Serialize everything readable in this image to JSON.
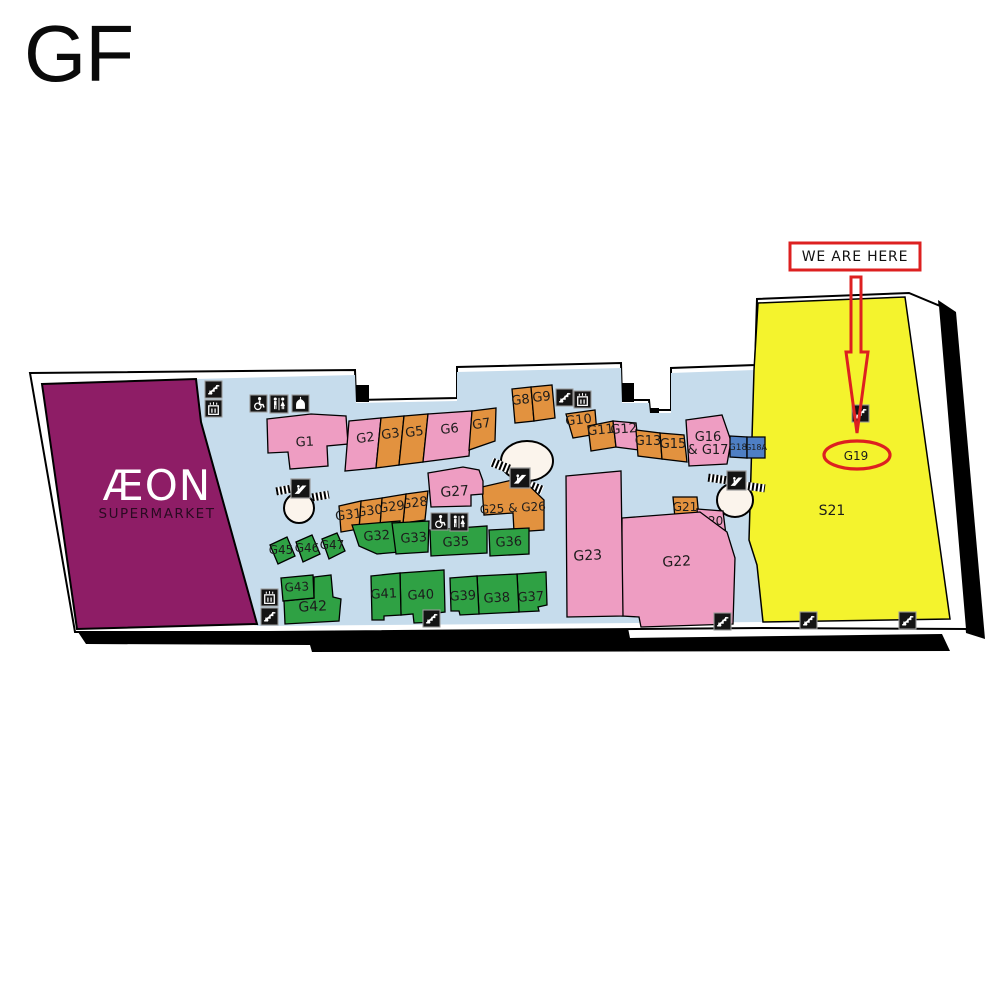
{
  "title": "GF",
  "annotation": {
    "we_are_here": "WE ARE HERE"
  },
  "colors": {
    "pink": "#ee9dc2",
    "orange": "#e2923f",
    "green": "#2fa144",
    "blue": "#4e7fc4",
    "purple": "#8e1d66",
    "yellow": "#f4f32d",
    "corridor": "#c6dcec",
    "red": "#dd2020",
    "circle": "#fbf4ec",
    "outline": "#000000",
    "label": "#1c1c1c",
    "icon_bg": "#141414",
    "icon_fg": "#ffffff"
  },
  "map": {
    "building_outline": "30,373 355,370 356,400 457,398 457,367 621,363 622,400 649,400 650,410 671,410 671,368 755,365 757,299 909,293 940,306 967,629 763,628 268,632 75,632",
    "shadow": [
      "78,632 628,628 630,638 942,634 950,651 312,652 310,645 86,644",
      "938,300 956,312 985,639 966,633"
    ],
    "pillars": [
      {
        "x": 356,
        "y": 385,
        "w": 13,
        "h": 17
      },
      {
        "x": 621,
        "y": 383,
        "w": 13,
        "h": 19
      },
      {
        "x": 647,
        "y": 408,
        "w": 12,
        "h": 11
      }
    ],
    "corridor": "196,379 355,375 356,403 457,401 457,372 621,368 622,403 649,403 650,413 671,413 671,373 754,370 749,540 757,565 763,622 257,626 201,424",
    "aeon": {
      "area": "42,384 196,379 201,422 257,624 77,629",
      "name": "ÆON",
      "sub": "SUPERMARKET",
      "x": 157,
      "y1": 500,
      "y2": 518
    },
    "yellow_area": "758,303 905,297 950,619 763,622 757,565 749,540 754,370",
    "area_labels": [
      {
        "text": "S21",
        "x": 832,
        "y": 515,
        "fs": 14
      },
      {
        "text": "G19",
        "x": 856,
        "y": 460,
        "fs": 12
      }
    ],
    "circles": [
      {
        "cx": 299,
        "cy": 508,
        "rx": 15,
        "ry": 15
      },
      {
        "cx": 527,
        "cy": 461,
        "rx": 26,
        "ry": 20
      },
      {
        "cx": 735,
        "cy": 500,
        "rx": 18,
        "ry": 17
      }
    ],
    "hatches": [
      {
        "x": 276,
        "y": 486,
        "w": 16,
        "h": 8,
        "rot": -10
      },
      {
        "x": 312,
        "y": 492,
        "w": 17,
        "h": 8,
        "rot": -10
      },
      {
        "x": 491,
        "y": 461,
        "w": 19,
        "h": 9,
        "rot": 22
      },
      {
        "x": 523,
        "y": 482,
        "w": 20,
        "h": 9,
        "rot": 22
      },
      {
        "x": 708,
        "y": 475,
        "w": 20,
        "h": 8,
        "rot": 8
      },
      {
        "x": 745,
        "y": 483,
        "w": 20,
        "h": 8,
        "rot": 8
      }
    ],
    "shops": [
      {
        "id": "G1",
        "label": "G1",
        "c": "pink",
        "pts": "267,419 311,414 346,416 348,444 327,446 328,466 290,469 288,452 268,453",
        "lx": 305,
        "ly": 446,
        "fs": 13,
        "rot": -3
      },
      {
        "id": "G2",
        "label": "G2",
        "c": "pink",
        "pts": "349,421 381,418 376,468 345,471",
        "lx": 366,
        "ly": 442,
        "fs": 13,
        "rot": -8
      },
      {
        "id": "G3",
        "label": "G3",
        "c": "orange",
        "pts": "381,418 404,416 399,465 376,468",
        "lx": 391,
        "ly": 438,
        "fs": 13,
        "rot": -8
      },
      {
        "id": "G5",
        "label": "G5",
        "c": "orange",
        "pts": "404,416 428,414 423,462 399,465",
        "lx": 415,
        "ly": 436,
        "fs": 13,
        "rot": -8
      },
      {
        "id": "G6",
        "label": "G6",
        "c": "pink",
        "pts": "428,414 472,411 469,456 423,462",
        "lx": 450,
        "ly": 433,
        "fs": 13,
        "rot": -6
      },
      {
        "id": "G7",
        "label": "G7",
        "c": "orange",
        "pts": "472,411 496,408 495,441 469,450",
        "lx": 482,
        "ly": 428,
        "fs": 13,
        "rot": -8
      },
      {
        "id": "G8",
        "label": "G8",
        "c": "orange",
        "pts": "512,389 531,387 534,421 515,423",
        "lx": 521,
        "ly": 404,
        "fs": 13,
        "rot": -6
      },
      {
        "id": "G9",
        "label": "G9",
        "c": "orange",
        "pts": "531,387 552,385 555,418 534,421",
        "lx": 542,
        "ly": 401,
        "fs": 13,
        "rot": -6
      },
      {
        "id": "G10",
        "label": "G10",
        "c": "orange",
        "pts": "566,414 595,410 597,434 573,438",
        "lx": 579,
        "ly": 424,
        "fs": 13,
        "rot": -6
      },
      {
        "id": "G11",
        "label": "G11",
        "c": "orange",
        "pts": "588,426 613,421 616,447 591,451",
        "lx": 601,
        "ly": 434,
        "fs": 13,
        "rot": -6
      },
      {
        "id": "G12",
        "label": "G12",
        "c": "pink",
        "pts": "613,421 636,423 639,450 616,447",
        "lx": 624,
        "ly": 433,
        "fs": 13,
        "rot": -4
      },
      {
        "id": "G13",
        "label": "G13",
        "c": "orange",
        "pts": "636,430 660,433 662,459 638,456",
        "lx": 648,
        "ly": 445,
        "fs": 13,
        "rot": 0
      },
      {
        "id": "G15",
        "label": "G15",
        "c": "orange",
        "pts": "660,433 684,435 687,462 662,459",
        "lx": 673,
        "ly": 448,
        "fs": 13,
        "rot": 0
      },
      {
        "id": "G16G17",
        "label": "G16",
        "label_lines": [
          "G16",
          "& G17"
        ],
        "c": "pink",
        "pts": "686,420 722,415 731,441 727,464 689,466",
        "lx": 708,
        "ly": 441,
        "fs": 13,
        "rot": 0
      },
      {
        "id": "G18",
        "label": "G18",
        "c": "blue",
        "pts": "730,436 747,437 747,458 730,457",
        "lx": 738,
        "ly": 450,
        "fs": 9,
        "rot": 0
      },
      {
        "id": "G18A",
        "label": "G18A",
        "c": "blue",
        "pts": "747,437 765,437 765,458 747,458",
        "lx": 756,
        "ly": 450,
        "fs": 8,
        "rot": 0
      },
      {
        "id": "G21",
        "label": "G21",
        "c": "orange",
        "pts": "673,497 697,497 699,518 675,518",
        "lx": 685,
        "ly": 511,
        "fs": 12,
        "rot": 0
      },
      {
        "id": "G20",
        "label": "G20",
        "c": "pink",
        "pts": "697,509 723,511 726,535 699,534",
        "lx": 711,
        "ly": 525,
        "fs": 12,
        "rot": 0
      },
      {
        "id": "G22",
        "label": "G22",
        "c": "pink",
        "pts": "622,518 700,512 727,532 735,558 733,624 641,627 639,617 622,616",
        "lx": 677,
        "ly": 566,
        "fs": 14,
        "rot": -3
      },
      {
        "id": "G23",
        "label": "G23",
        "c": "pink",
        "pts": "566,476 621,471 623,616 567,617",
        "lx": 588,
        "ly": 560,
        "fs": 14,
        "rot": -3
      },
      {
        "id": "G25G26",
        "label": "G25 & G26",
        "c": "orange",
        "pts": "482,487 521,478 544,500 544,530 514,532 513,513 484,515",
        "lx": 513,
        "ly": 512,
        "fs": 12,
        "rot": -3
      },
      {
        "id": "G27",
        "label": "G27",
        "c": "pink",
        "pts": "428,473 463,467 479,470 483,481 483,494 471,495 471,506 431,507",
        "lx": 455,
        "ly": 496,
        "fs": 14,
        "rot": -4
      },
      {
        "id": "G28",
        "label": "G28",
        "c": "orange",
        "pts": "406,494 428,491 425,520 403,523",
        "lx": 415,
        "ly": 507,
        "fs": 13,
        "rot": -7
      },
      {
        "id": "G29",
        "label": "G29",
        "c": "orange",
        "pts": "382,498 406,494 403,523 380,526",
        "lx": 392,
        "ly": 511,
        "fs": 13,
        "rot": -7
      },
      {
        "id": "G30",
        "label": "G30",
        "c": "orange",
        "pts": "361,501 382,498 380,526 359,529",
        "lx": 370,
        "ly": 515,
        "fs": 13,
        "rot": -7
      },
      {
        "id": "G31",
        "label": "G31",
        "c": "orange",
        "pts": "339,506 361,501 359,529 341,532",
        "lx": 349,
        "ly": 519,
        "fs": 13,
        "rot": -7
      },
      {
        "id": "G32",
        "label": "G32",
        "c": "green",
        "pts": "352,525 400,521 399,552 377,554 359,546",
        "lx": 377,
        "ly": 540,
        "fs": 13,
        "rot": -4
      },
      {
        "id": "G33",
        "label": "G33",
        "c": "green",
        "pts": "392,523 429,521 428,552 396,554",
        "lx": 414,
        "ly": 542,
        "fs": 13,
        "rot": -4
      },
      {
        "id": "G35",
        "label": "G35",
        "c": "green",
        "pts": "430,530 487,526 487,553 431,556",
        "lx": 456,
        "ly": 546,
        "fs": 13,
        "rot": -3
      },
      {
        "id": "G36",
        "label": "G36",
        "c": "green",
        "pts": "489,530 529,528 529,554 490,556",
        "lx": 509,
        "ly": 546,
        "fs": 13,
        "rot": -3
      },
      {
        "id": "G37",
        "label": "G37",
        "c": "green",
        "pts": "517,574 546,572 547,605 538,607 539,611 519,612",
        "lx": 531,
        "ly": 601,
        "fs": 13,
        "rot": -3
      },
      {
        "id": "G38",
        "label": "G38",
        "c": "green",
        "pts": "477,576 517,574 519,612 479,614",
        "lx": 497,
        "ly": 602,
        "fs": 13,
        "rot": -3
      },
      {
        "id": "G39",
        "label": "G39",
        "c": "green",
        "pts": "450,578 477,576 479,614 460,615 459,611 451,611",
        "lx": 463,
        "ly": 600,
        "fs": 13,
        "rot": -3
      },
      {
        "id": "G40",
        "label": "G40",
        "c": "green",
        "pts": "400,573 444,570 445,612 437,613 438,622 414,623 413,614 401,615",
        "lx": 421,
        "ly": 599,
        "fs": 13,
        "rot": -3
      },
      {
        "id": "G41",
        "label": "G41",
        "c": "green",
        "pts": "371,576 400,573 401,615 384,616 384,620 372,620",
        "lx": 384,
        "ly": 598,
        "fs": 13,
        "rot": -3
      },
      {
        "id": "G42",
        "label": "G42",
        "c": "green",
        "pts": "314,577 331,575 333,597 341,599 339,621 285,624 284,601 314,598",
        "lx": 313,
        "ly": 611,
        "fs": 14,
        "rot": -3
      },
      {
        "id": "G43",
        "label": "G43",
        "c": "green",
        "pts": "281,578 313,575 314,598 283,601",
        "lx": 297,
        "ly": 591,
        "fs": 12,
        "rot": -3
      },
      {
        "id": "G45",
        "label": "G45",
        "c": "green",
        "pts": "270,545 287,537 295,556 278,564",
        "lx": 281,
        "ly": 554,
        "fs": 12,
        "rot": 0
      },
      {
        "id": "G46",
        "label": "G46",
        "c": "green",
        "pts": "296,542 312,535 320,554 303,562",
        "lx": 307,
        "ly": 552,
        "fs": 12,
        "rot": 0
      },
      {
        "id": "G47",
        "label": "G47",
        "c": "green",
        "pts": "322,539 337,533 345,551 329,559",
        "lx": 332,
        "ly": 549,
        "fs": 12,
        "rot": 0
      }
    ],
    "icons": [
      {
        "t": "stairs",
        "x": 205,
        "y": 381,
        "s": 17
      },
      {
        "t": "lift",
        "x": 205,
        "y": 400,
        "s": 17
      },
      {
        "t": "wheelchair",
        "x": 250,
        "y": 395,
        "s": 17
      },
      {
        "t": "toilets",
        "x": 270,
        "y": 395,
        "s": 18
      },
      {
        "t": "prayer",
        "x": 292,
        "y": 395,
        "s": 17
      },
      {
        "t": "stairs",
        "x": 556,
        "y": 389,
        "s": 17
      },
      {
        "t": "lift",
        "x": 574,
        "y": 391,
        "s": 17
      },
      {
        "t": "wheelchair",
        "x": 431,
        "y": 513,
        "s": 17
      },
      {
        "t": "toilets",
        "x": 450,
        "y": 513,
        "s": 18
      },
      {
        "t": "lift",
        "x": 261,
        "y": 589,
        "s": 17
      },
      {
        "t": "stairs",
        "x": 261,
        "y": 608,
        "s": 17
      },
      {
        "t": "stairs",
        "x": 423,
        "y": 610,
        "s": 17
      },
      {
        "t": "stairs",
        "x": 714,
        "y": 613,
        "s": 17
      },
      {
        "t": "stairs",
        "x": 800,
        "y": 612,
        "s": 17
      },
      {
        "t": "stairs",
        "x": 899,
        "y": 612,
        "s": 17
      },
      {
        "t": "stairs",
        "x": 852,
        "y": 405,
        "s": 17
      },
      {
        "t": "escalator",
        "x": 291,
        "y": 479,
        "s": 19
      },
      {
        "t": "escalator",
        "x": 510,
        "y": 468,
        "s": 20
      },
      {
        "t": "escalator",
        "x": 727,
        "y": 471,
        "s": 19
      }
    ],
    "red_marker": {
      "box": {
        "x": 790,
        "y": 243,
        "w": 130,
        "h": 27
      },
      "label_x": 855,
      "label_y": 261,
      "arrow": "851,277 861,277 861,352 868,352 857,433 846,352 851,352",
      "ellipse": {
        "cx": 857,
        "cy": 455,
        "rx": 33,
        "ry": 14
      }
    }
  }
}
